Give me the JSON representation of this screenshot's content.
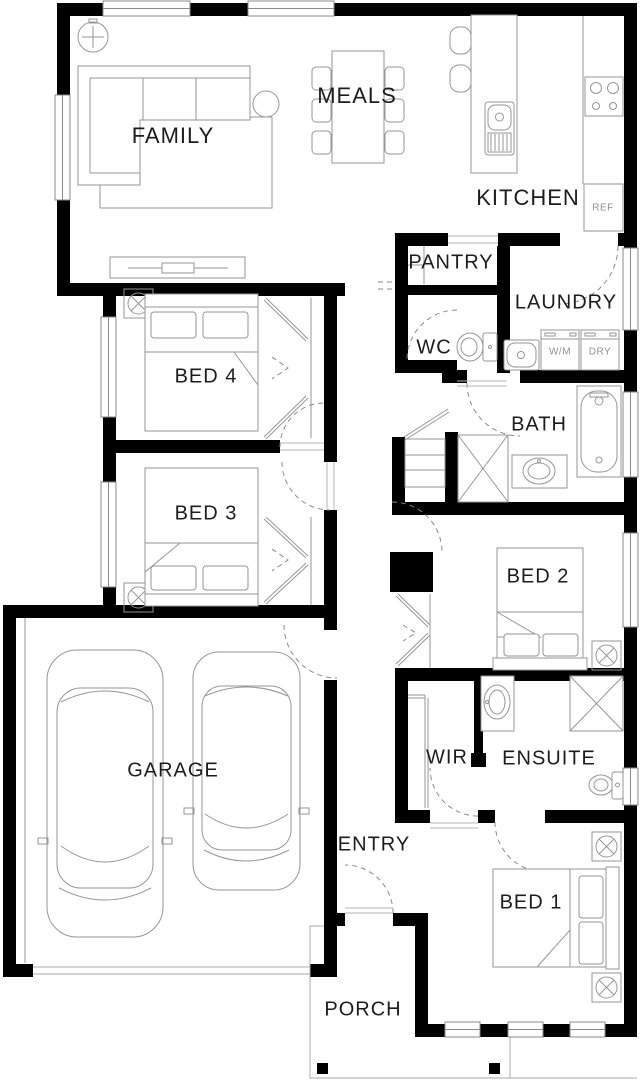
{
  "title": "Single storey house floor plan",
  "rooms": {
    "family": "FAMILY",
    "meals": "MEALS",
    "kitchen": "KITCHEN",
    "pantry": "PANTRY",
    "laundry": "LAUNDRY",
    "wc": "WC",
    "bath": "BATH",
    "bed4": "BED 4",
    "bed3": "BED 3",
    "bed2": "BED 2",
    "garage": "GARAGE",
    "wir": "WIR",
    "ensuite": "ENSUITE",
    "entry": "ENTRY",
    "bed1": "BED 1",
    "porch": "PORCH"
  },
  "appliances": {
    "fridge": "REF",
    "washing_machine": "W/M",
    "dryer": "DRY"
  },
  "colors": {
    "wall": "#000000",
    "fixture_line": "#969696",
    "label_text": "#1c1c1c",
    "small_label_text": "#8f8f8f",
    "background": "#ffffff"
  }
}
